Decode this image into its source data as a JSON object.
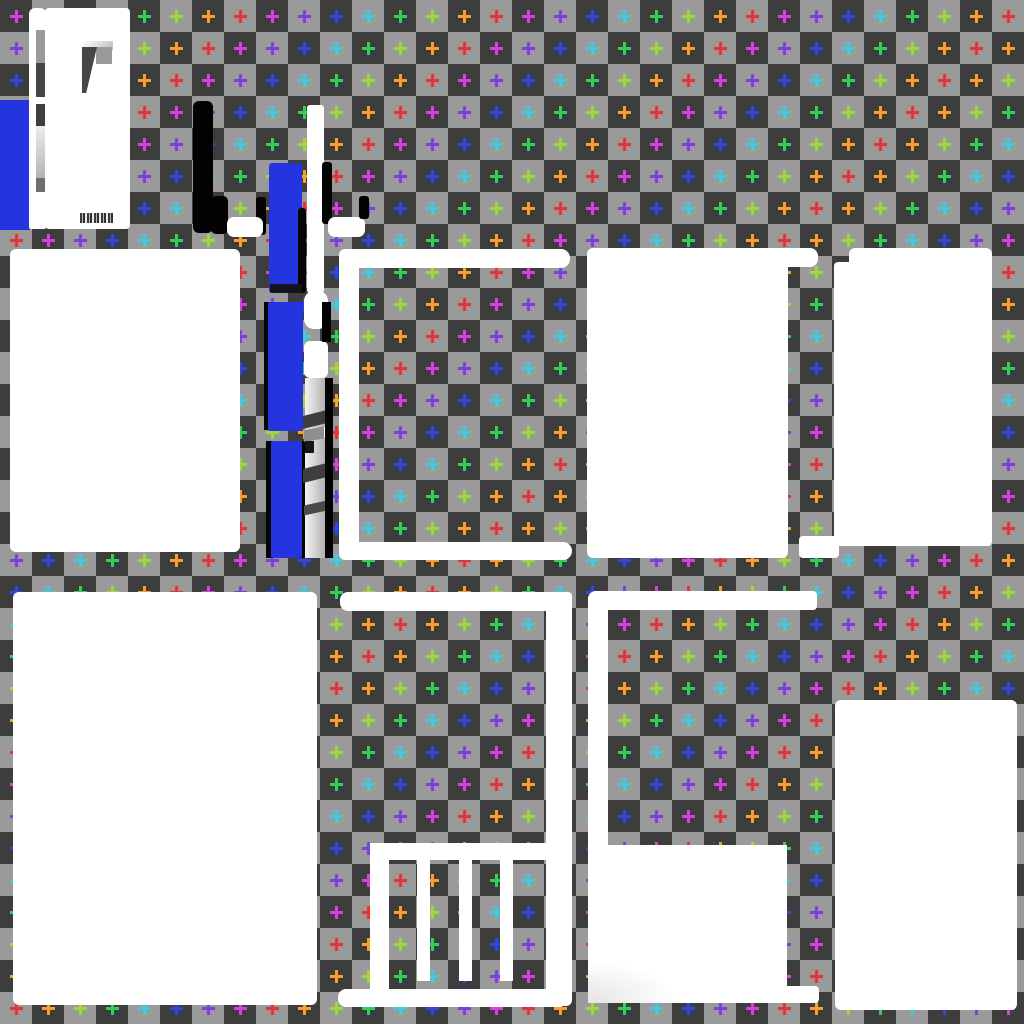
{
  "canvas": {
    "width": 1024,
    "height": 1024
  },
  "checkerboard": {
    "cell_size": 32,
    "dark": "#3d3d3d",
    "light": "#9a9a9a",
    "origin_cell": "dark"
  },
  "plus_markers": {
    "comment_pattern": "anti-diagonal rainbow, mirrored at sum=31; index=(min(ix+iy,62-(ix+iy))+phase)%8",
    "grid_cols": 32,
    "grid_rows": 32,
    "cell": 32,
    "size": 13,
    "stroke": 3,
    "phase": 5,
    "mirror_sum": 31,
    "palette": [
      "#38cfe0",
      "#2fd156",
      "#9ddd33",
      "#f3a427",
      "#e63434",
      "#d842d8",
      "#7d3fe2",
      "#2c47ea"
    ],
    "palette_names": [
      "cyan",
      "green",
      "lime",
      "orange",
      "red",
      "magenta",
      "purple",
      "blue"
    ]
  },
  "accents": {
    "sprite_blue": "#2435df",
    "sprite_black": "#020202",
    "sprite_white": "#ffffff"
  },
  "shapes": [
    {
      "name": "blue-block-left-edge",
      "x": 0,
      "y": 100,
      "w": 30,
      "h": 130,
      "fill": "#2435df"
    },
    {
      "name": "white-strip-tall",
      "x": 29,
      "y": 8,
      "w": 17,
      "h": 221,
      "fill": "#ffffff",
      "radius": "6px 6px 2px 2px"
    },
    {
      "name": "strip-segment-gray",
      "x": 36,
      "y": 30,
      "w": 10,
      "h": 33,
      "fill": "#9b9b9b"
    },
    {
      "name": "strip-segment-dark-1",
      "x": 36,
      "y": 63,
      "w": 10,
      "h": 34,
      "fill": "#454545"
    },
    {
      "name": "strip-segment-dark-2",
      "x": 36,
      "y": 104,
      "w": 10,
      "h": 22,
      "fill": "#3f3f3f"
    },
    {
      "name": "strip-segment-gradient",
      "x": 36,
      "y": 126,
      "w": 10,
      "h": 52,
      "fill": "linear-gradient(180deg,#ededed,#b3b3b3)"
    },
    {
      "name": "strip-segment-dark-3",
      "x": 36,
      "y": 178,
      "w": 10,
      "h": 14,
      "fill": "#6e6e6e"
    },
    {
      "name": "white-panel-top-left",
      "x": 45,
      "y": 8,
      "w": 85,
      "h": 221,
      "fill": "#ffffff",
      "radius": "4px"
    },
    {
      "name": "flag-light-band",
      "x": 82,
      "y": 41,
      "w": 31,
      "h": 9,
      "fill": "linear-gradient(135deg,#ffffff,#bdbdbd)"
    },
    {
      "name": "flag-gray-elbow",
      "x": 96,
      "y": 47,
      "w": 16,
      "h": 17,
      "fill": "#9a9a9a"
    },
    {
      "name": "flag-dark-wedge",
      "x": 82,
      "y": 47,
      "w": 15,
      "h": 46,
      "fill": "#474747",
      "clip": "polygon(0 0, 100% 0, 28% 100%, 0 100%)"
    },
    {
      "name": "illegible-signature-pixels",
      "x": 80,
      "y": 213,
      "w": 33,
      "h": 10,
      "fill": "repeating-linear-gradient(90deg,#3a3a3a 0 2px,rgba(150,150,150,0.65) 2px 3px,#30303d 3px 5px,rgba(200,200,200,0.4) 5px 7px)"
    },
    {
      "name": "black-bar-a",
      "x": 193,
      "y": 101,
      "w": 20,
      "h": 132,
      "fill": "#020202",
      "radius": "6px"
    },
    {
      "name": "black-blob-b",
      "x": 211,
      "y": 196,
      "w": 17,
      "h": 38,
      "fill": "#020202",
      "radius": "5px"
    },
    {
      "name": "black-bar-d",
      "x": 256,
      "y": 197,
      "w": 10,
      "h": 38,
      "fill": "#020202",
      "radius": "3px"
    },
    {
      "name": "white-bar-c",
      "x": 227,
      "y": 217,
      "w": 36,
      "h": 20,
      "fill": "#ffffff",
      "radius": "7px"
    },
    {
      "name": "blue-segment-1",
      "x": 269,
      "y": 163,
      "w": 33,
      "h": 130,
      "fill": "#2435df",
      "radius": "3px"
    },
    {
      "name": "blue-segment-1-black-edge",
      "x": 298,
      "y": 208,
      "w": 8,
      "h": 85,
      "fill": "#050505",
      "radius": "3px"
    },
    {
      "name": "blue-segment-1-shadow",
      "x": 270,
      "y": 284,
      "w": 32,
      "h": 9,
      "fill": "#14141f",
      "radius": "2px"
    },
    {
      "name": "blue-segment-2-black-left",
      "x": 264,
      "y": 302,
      "w": 6,
      "h": 128,
      "fill": "#050505"
    },
    {
      "name": "blue-segment-2",
      "x": 268,
      "y": 302,
      "w": 35,
      "h": 129,
      "fill": "#2435df",
      "radius": "2px"
    },
    {
      "name": "blue-segment-3-black-left",
      "x": 266,
      "y": 441,
      "w": 7,
      "h": 117,
      "fill": "#050505"
    },
    {
      "name": "blue-segment-3-black-right",
      "x": 301,
      "y": 441,
      "w": 10,
      "h": 117,
      "fill": "#050505"
    },
    {
      "name": "blue-segment-3",
      "x": 271,
      "y": 441,
      "w": 31,
      "h": 117,
      "fill": "#2435df",
      "radius": "2px"
    },
    {
      "name": "white-column-e",
      "x": 307,
      "y": 105,
      "w": 17,
      "h": 188,
      "fill": "#ffffff",
      "radius": "3px"
    },
    {
      "name": "black-bar-f",
      "x": 322,
      "y": 162,
      "w": 10,
      "h": 62,
      "fill": "#020202",
      "radius": "3px"
    },
    {
      "name": "white-blob-g",
      "x": 304,
      "y": 291,
      "w": 24,
      "h": 38,
      "fill": "#ffffff",
      "radius": "10px"
    },
    {
      "name": "white-rounded-h",
      "x": 304,
      "y": 341,
      "w": 24,
      "h": 37,
      "fill": "#ffffff",
      "radius": "6px"
    },
    {
      "name": "gray-stack-base",
      "x": 305,
      "y": 378,
      "w": 22,
      "h": 180,
      "fill": "linear-gradient(90deg,#f4f4f4,#ababab)"
    },
    {
      "name": "gray-stack-separator-1",
      "x": 303,
      "y": 413,
      "w": 24,
      "h": 13,
      "fill": "#3e3e3e",
      "skew": -14
    },
    {
      "name": "gray-stack-mid-gray",
      "x": 304,
      "y": 428,
      "w": 23,
      "h": 12,
      "fill": "#8f8f8f",
      "skew": -10
    },
    {
      "name": "gray-stack-black-notch",
      "x": 305,
      "y": 441,
      "w": 9,
      "h": 12,
      "fill": "#161616"
    },
    {
      "name": "gray-stack-separator-2",
      "x": 303,
      "y": 466,
      "w": 24,
      "h": 14,
      "fill": "#3e3e3e",
      "skew": -14
    },
    {
      "name": "gray-stack-separator-3",
      "x": 304,
      "y": 503,
      "w": 23,
      "h": 10,
      "fill": "#4a4a4a",
      "skew": -12
    },
    {
      "name": "gray-stack-white-sliver",
      "x": 324,
      "y": 427,
      "w": 5,
      "h": 11,
      "fill": "#ffffff"
    },
    {
      "name": "black-edge-right-top",
      "x": 322,
      "y": 302,
      "w": 9,
      "h": 40,
      "fill": "#020202"
    },
    {
      "name": "black-edge-right-long",
      "x": 325,
      "y": 378,
      "w": 8,
      "h": 180,
      "fill": "#020202"
    },
    {
      "name": "white-bar-j",
      "x": 328,
      "y": 217,
      "w": 37,
      "h": 20,
      "fill": "#ffffff",
      "radius": "7px"
    },
    {
      "name": "black-bar-k",
      "x": 359,
      "y": 196,
      "w": 10,
      "h": 23,
      "fill": "#020202",
      "radius": "3px"
    },
    {
      "name": "rect-mid-left",
      "x": 10,
      "y": 249,
      "w": 230,
      "h": 303,
      "fill": "#ffffff",
      "radius": "6px"
    },
    {
      "name": "frame1-top-bar",
      "x": 339,
      "y": 249,
      "w": 231,
      "h": 19,
      "fill": "#ffffff",
      "radius": "6px 9px 9px 0"
    },
    {
      "name": "frame1-left-bar",
      "x": 339,
      "y": 249,
      "w": 20,
      "h": 310,
      "fill": "#ffffff",
      "radius": "6px 0 0 6px"
    },
    {
      "name": "frame1-bottom-bar",
      "x": 339,
      "y": 542,
      "w": 233,
      "h": 18,
      "fill": "#ffffff",
      "radius": "0 9px 9px 6px"
    },
    {
      "name": "rect-mid-center",
      "x": 587,
      "y": 248,
      "w": 201,
      "h": 310,
      "fill": "#ffffff",
      "radius": "6px"
    },
    {
      "name": "rect-mid-center-top-ext",
      "x": 775,
      "y": 248,
      "w": 43,
      "h": 19,
      "fill": "#ffffff",
      "radius": "0 8px 8px 0"
    },
    {
      "name": "rect-mid-right-top-step",
      "x": 849,
      "y": 248,
      "w": 143,
      "h": 20,
      "fill": "#ffffff",
      "radius": "6px 6px 0 0"
    },
    {
      "name": "rect-mid-right",
      "x": 834,
      "y": 262,
      "w": 158,
      "h": 284,
      "fill": "#ffffff",
      "radius": "4px"
    },
    {
      "name": "rect-mid-right-bottom-tab",
      "x": 799,
      "y": 536,
      "w": 40,
      "h": 22,
      "fill": "#ffffff",
      "radius": "4px"
    },
    {
      "name": "rect-bottom-left",
      "x": 13,
      "y": 592,
      "w": 304,
      "h": 413,
      "fill": "#ffffff",
      "radius": "6px"
    },
    {
      "name": "frame2-top-bar",
      "x": 340,
      "y": 592,
      "w": 232,
      "h": 19,
      "fill": "#ffffff",
      "radius": "8px 4px 0 8px"
    },
    {
      "name": "frame2-right-bar",
      "x": 546,
      "y": 592,
      "w": 26,
      "h": 414,
      "fill": "#ffffff",
      "radius": "0 6px 6px 0"
    },
    {
      "name": "frame2-shelf-bar",
      "x": 370,
      "y": 843,
      "w": 183,
      "h": 17,
      "fill": "#ffffff"
    },
    {
      "name": "frame2-left-leg",
      "x": 370,
      "y": 843,
      "w": 19,
      "h": 163,
      "fill": "#ffffff",
      "radius": "6px 0 0 0"
    },
    {
      "name": "frame2-tooth-1",
      "x": 417,
      "y": 857,
      "w": 13,
      "h": 124,
      "fill": "#ffffff"
    },
    {
      "name": "frame2-tooth-2",
      "x": 459,
      "y": 857,
      "w": 13,
      "h": 124,
      "fill": "#ffffff"
    },
    {
      "name": "frame2-tooth-3",
      "x": 500,
      "y": 857,
      "w": 13,
      "h": 124,
      "fill": "#ffffff"
    },
    {
      "name": "frame2-bottom-bar",
      "x": 338,
      "y": 989,
      "w": 229,
      "h": 18,
      "fill": "#ffffff",
      "radius": "8px"
    },
    {
      "name": "frame3-top-bar",
      "x": 588,
      "y": 591,
      "w": 229,
      "h": 19,
      "fill": "#ffffff",
      "radius": "8px 4px 4px 0"
    },
    {
      "name": "frame3-left-bar",
      "x": 588,
      "y": 591,
      "w": 20,
      "h": 412,
      "fill": "#ffffff",
      "radius": "8px 0 0 2px"
    },
    {
      "name": "rect-bottom-mid",
      "x": 588,
      "y": 845,
      "w": 199,
      "h": 158,
      "fill": "radial-gradient(150px 70px at 0% 100%, #e4e4e4, #ffffff 60%)"
    },
    {
      "name": "rect-bottom-mid-tab",
      "x": 787,
      "y": 986,
      "w": 32,
      "h": 17,
      "fill": "#ffffff",
      "radius": "0 4px 4px 0"
    },
    {
      "name": "rect-bottom-right",
      "x": 835,
      "y": 700,
      "w": 182,
      "h": 310,
      "fill": "#ffffff",
      "radius": "6px"
    }
  ]
}
